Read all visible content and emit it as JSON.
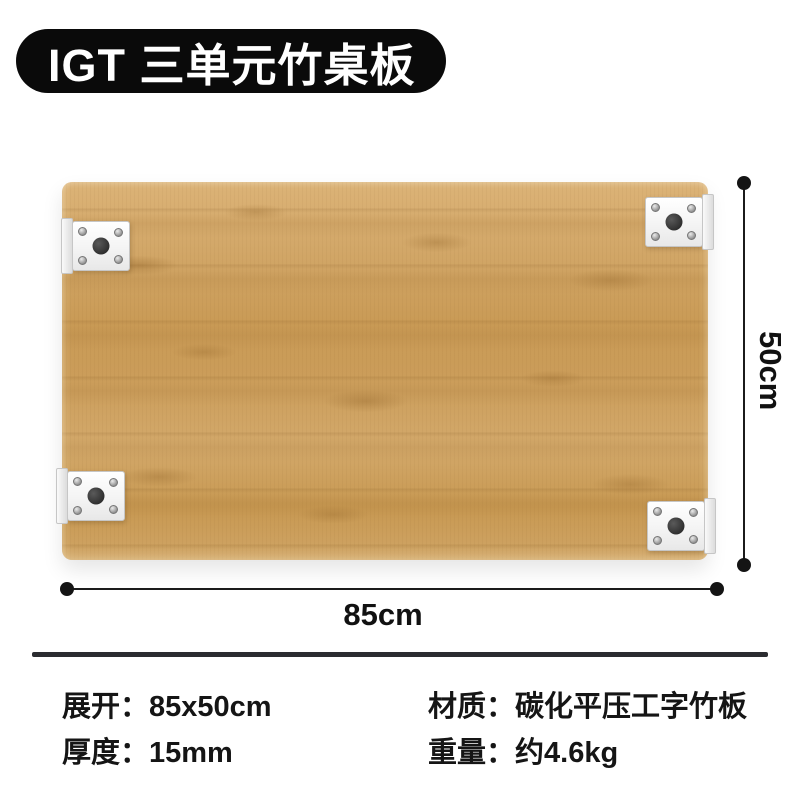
{
  "badge": {
    "title": "IGT 三单元竹桌板"
  },
  "product": {
    "dimension_width_label": "85cm",
    "dimension_height_label": "50cm"
  },
  "specs": {
    "left": [
      {
        "label": "展开：",
        "value": "85x50cm"
      },
      {
        "label": "厚度：",
        "value": "15mm"
      }
    ],
    "right": [
      {
        "label": "材质：",
        "value": "碳化平压工字竹板"
      },
      {
        "label": "重量：",
        "value": "约4.6kg"
      }
    ]
  },
  "colors": {
    "badge_bg": "#0a0a0a",
    "badge_text": "#ffffff",
    "wood_base": "#d0a566",
    "wood_dark": "#b08449",
    "bracket_plate": "#f4f4f4",
    "dimension_line": "#1b1b1b",
    "divider": "#2b2c30",
    "spec_text": "#151515",
    "background": "#ffffff"
  }
}
